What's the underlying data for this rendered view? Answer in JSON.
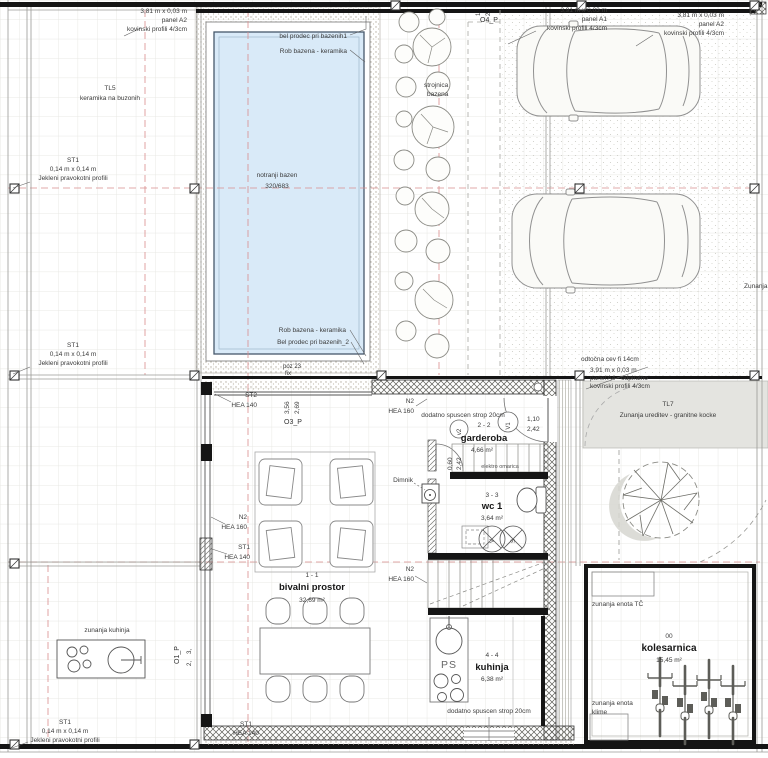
{
  "colors": {
    "pool_water": "#d9eaf8",
    "wall_black": "#151515",
    "axis_red": "#d98d8d",
    "paving_gray": "#e4e4e0"
  },
  "labels": {
    "panel_a2": {
      "l1": "3,81 m x 0,03 m",
      "l2": "panel A2",
      "l3": "kovinski profili 4/3cm"
    },
    "panel_a1": {
      "l1": "3,91 m x 0,03 m",
      "l2": "panel A1",
      "l3": "kovinski profili 4/3cm"
    },
    "panel_a4": {
      "l1": "3,91 m x 0,03 m",
      "l2": "panel A4 - odpiralno",
      "l3": "kovinski profili 4/3cm"
    },
    "tl5": {
      "l1": "TL5",
      "l2": "keramika na buzonih"
    },
    "tl7": {
      "l1": "TL7",
      "l2": "Zunanja ureditev - granitne kocke"
    },
    "st1_col": {
      "l1": "ST1",
      "l2": "0,14 m x 0,14 m",
      "l3": "Jekleni pravokotni profili"
    },
    "pool": {
      "top1": "bel prodec pri bazenih1",
      "top2": "Rob bazena - keramika",
      "name": "notranji bazen",
      "size": "320/683",
      "bot1": "Rob bazena - keramika",
      "bot2": "Bel prodec pri bazenih_2",
      "poz": "poz 23",
      "fix": "fix"
    },
    "strojnica": {
      "l1": "strojnica",
      "l2": "bazena"
    },
    "o4p": "O4_P",
    "o3p": "O3_P",
    "o1p": "O1_P",
    "dims": {
      "d1": "1",
      "d2": "2",
      "d3": "3,",
      "d4": "2,"
    },
    "odtocna": "odtočna cev fi 14cm",
    "zunanja": "Zunanja",
    "st2": "ST2",
    "hea140": "HEA 140",
    "n2": "N2",
    "hea160": "HEA 160",
    "st1": "ST1",
    "d356": "3,56",
    "d269": "2,69",
    "dodatno": "dodatno spuscen strop 20cm",
    "garderoba": {
      "sec": "2 - 2",
      "name": "garderoba",
      "area": "4,66 m²",
      "v2": "v2",
      "v1": "V1",
      "d110": "1,10",
      "d242": "2,42",
      "d060": "0,60"
    },
    "elektro": "elektro omarica",
    "wc": {
      "sec": "3 - 3",
      "name": "wc 1",
      "area": "3,64 m²",
      "v": "V",
      "s": "S"
    },
    "dimnik": "Dimnik",
    "bivalni": {
      "sec": "1 - 1",
      "name": "bivalni prostor",
      "area": "32,69 m²"
    },
    "kuhinja": {
      "sec": "4 - 4",
      "name": "kuhinja",
      "area": "6,38 m²",
      "ps": "PS"
    },
    "zunanja_kuhinja": "zunanja kuhinja",
    "kolesarnica": {
      "num": "00",
      "name": "kolesarnica",
      "area": "15,45 m²"
    },
    "enota_tc": "zunanja enota TČ",
    "enota_klime": {
      "l1": "zunanja enota",
      "l2": "klime"
    }
  }
}
